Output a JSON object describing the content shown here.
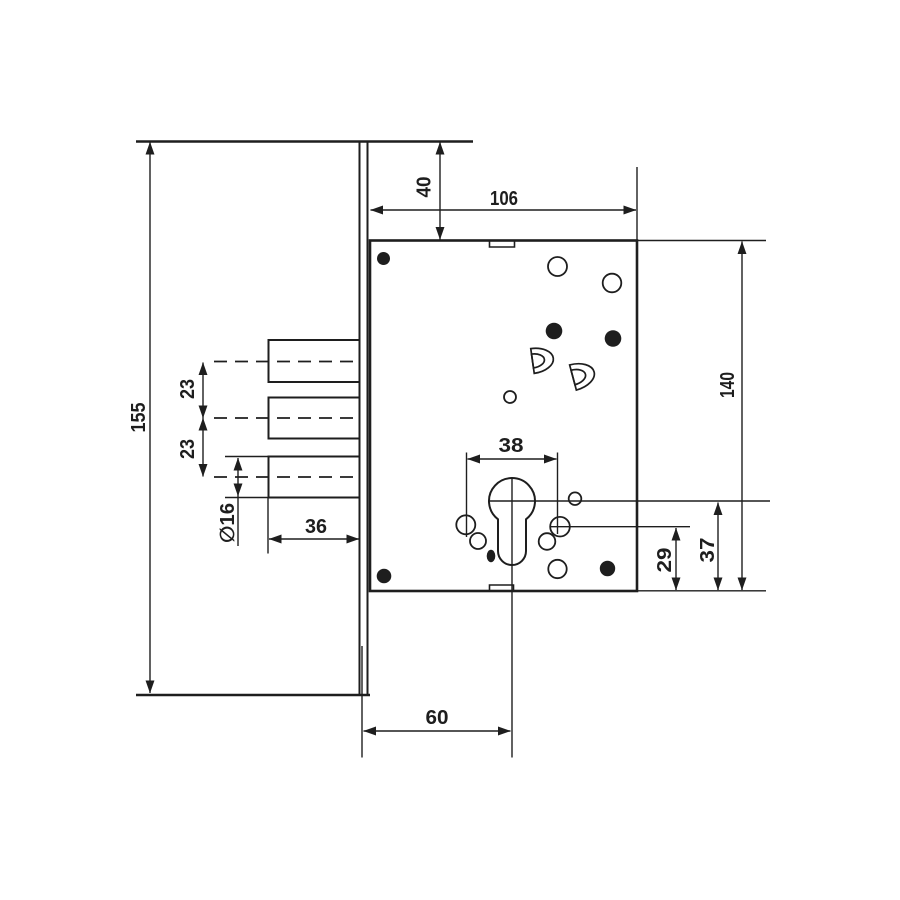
{
  "drawing": {
    "type": "technical-diagram",
    "subject": "mortise lock dimensional drawing",
    "background_color": "#ffffff",
    "line_color": "#1e1e1e",
    "labels": {
      "faceplate_length": "155",
      "top_offset": "40",
      "body_width": "106",
      "body_height": "140",
      "bolt_pitch_upper": "23",
      "bolt_pitch_lower": "23",
      "bolt_diameter": "∅16",
      "bolt_throw": "36",
      "cylinder_hole_width": "38",
      "lower_hole_offset": "29",
      "cylinder_axis_offset": "37",
      "backset": "60"
    }
  }
}
